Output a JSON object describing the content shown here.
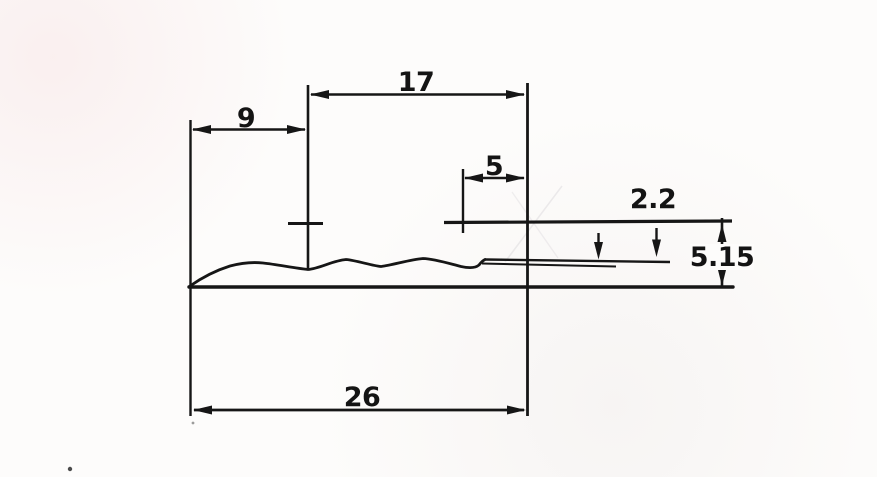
{
  "drawing": {
    "colors": {
      "ink": "#161616",
      "paper": "#fdfcfb"
    },
    "dimensions": {
      "upper_width": "17",
      "left_width": "9",
      "tail_width": "5",
      "tip_thickness": "2.2",
      "overall_height": "5.15",
      "overall_width": "26"
    }
  }
}
